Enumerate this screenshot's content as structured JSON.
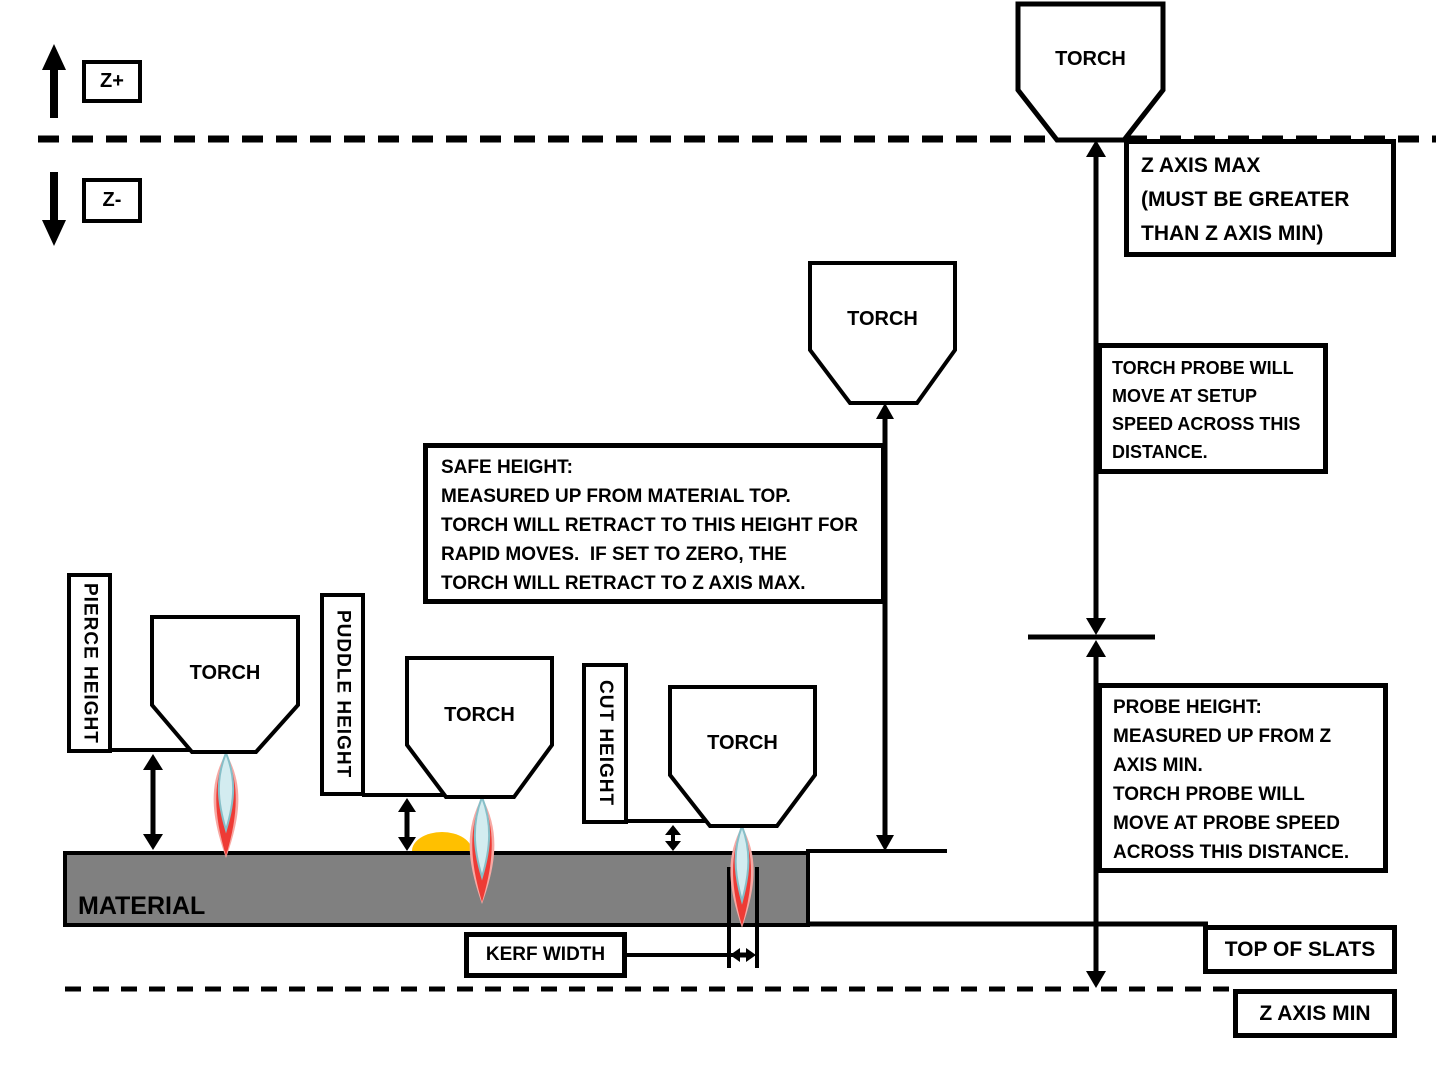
{
  "axis_indicator": {
    "z_plus": "Z+",
    "z_minus": "Z-"
  },
  "torch": {
    "label": "TORCH"
  },
  "material": {
    "label": "MATERIAL"
  },
  "callouts": {
    "z_axis_max": "Z AXIS MAX\n(MUST BE GREATER\nTHAN Z AXIS MIN)",
    "setup_speed": "TORCH PROBE WILL\nMOVE AT SETUP\nSPEED ACROSS THIS\nDISTANCE.",
    "safe_height": "SAFE HEIGHT:\nMEASURED UP FROM MATERIAL TOP.\nTORCH WILL RETRACT TO THIS HEIGHT FOR\nRAPID MOVES.  IF SET TO ZERO, THE\nTORCH WILL RETRACT TO Z AXIS MAX.",
    "probe_height": "PROBE HEIGHT:\nMEASURED UP FROM Z\nAXIS MIN.\nTORCH PROBE WILL\nMOVE AT PROBE SPEED\nACROSS THIS DISTANCE.",
    "pierce_height": "PIERCE HEIGHT",
    "puddle_height": "PUDDLE HEIGHT",
    "cut_height": "CUT HEIGHT",
    "kerf_width": "KERF WIDTH",
    "top_of_slats": "TOP OF SLATS",
    "z_axis_min": "Z AXIS MIN"
  },
  "colors": {
    "line": "#000000",
    "material_gray": "#808080",
    "puddle_orange": "#FFC000",
    "flame_outer_glow": "#F7A9A4",
    "flame_red": "#EE3B35",
    "flame_inner_blue": "#D3ECF0",
    "flame_inner_edge": "#86BFC8"
  }
}
